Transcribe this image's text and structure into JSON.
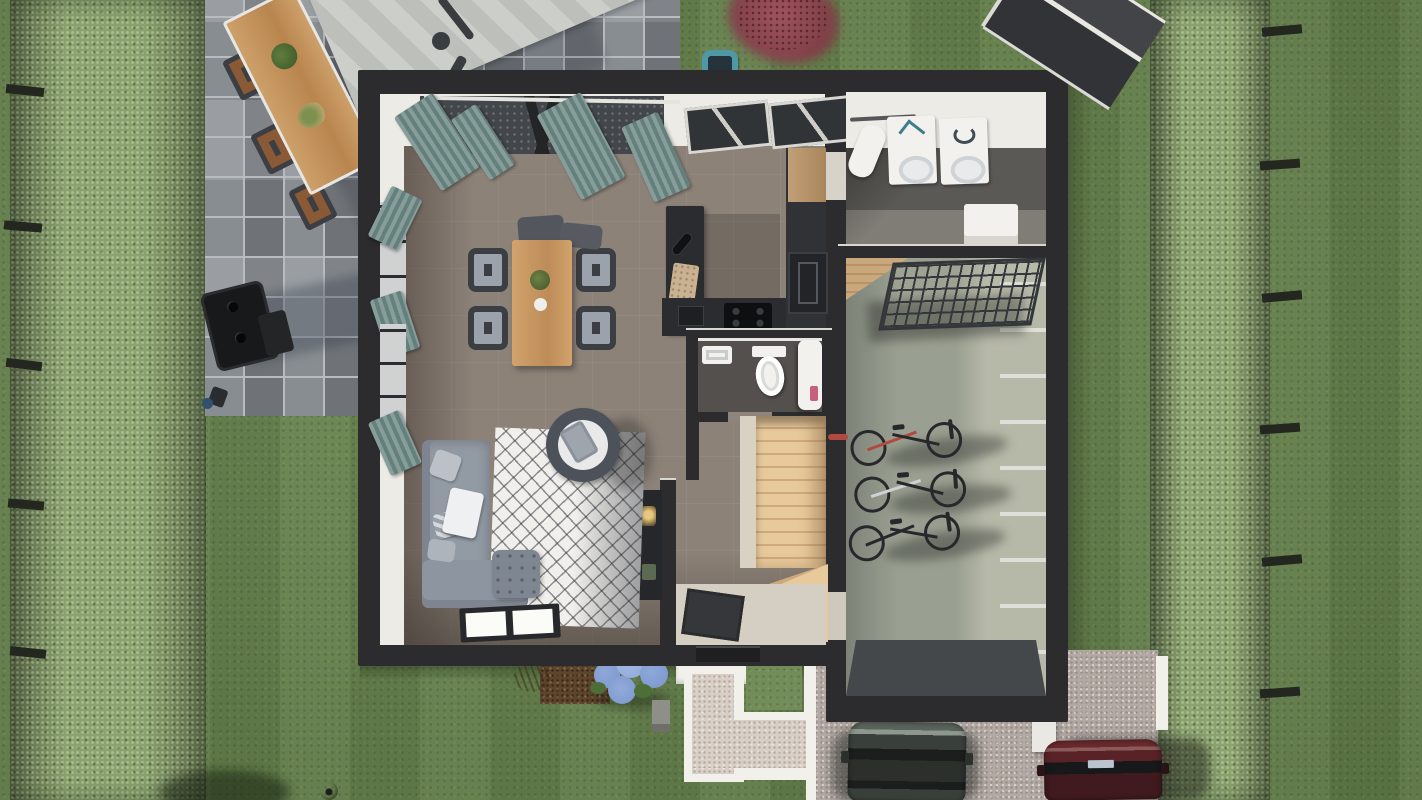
{
  "meta": {
    "view": "top-down 3D architectural floor-plan render",
    "rooms": [
      "living-dining-room",
      "kitchen",
      "wc",
      "entry-hall",
      "staircase",
      "laundry-room",
      "garage"
    ],
    "garden_objects": [
      "lawn",
      "left-hedge",
      "right-hedge",
      "fence-posts",
      "patio",
      "outdoor-dining-table",
      "outdoor-chairs",
      "cantilever-parasol",
      "bbq-grill",
      "garden-tap",
      "robot-mower-dock",
      "red-bush",
      "garden-shed",
      "hydrangea",
      "mulch-bed",
      "stoop",
      "l-shaped-path",
      "driveway",
      "car-gray",
      "car-red",
      "gate-post",
      "soccer-ball"
    ],
    "interior_objects": [
      "dining-table",
      "dining-chairs",
      "kitchen-island",
      "kitchen-counter",
      "hob",
      "tall-cabinet",
      "oven",
      "toilet",
      "wc-sink",
      "shower-column",
      "stairs",
      "winder-steps",
      "door-mat",
      "front-door",
      "shelf-unit",
      "corner-sofa",
      "ottoman",
      "rug",
      "tub-chair",
      "floor-window",
      "washing-machine",
      "dryer",
      "ironing-board",
      "water-heater",
      "wire-rack",
      "bicycles"
    ]
  },
  "colors": {
    "lawn": "#66834b",
    "hedge": "#8ba36c",
    "post": "#23271f",
    "paver": "#868b90",
    "paverJoint": "#b8bcc1",
    "parasol": "#c8cbc6",
    "parasolArm": "#3a3d3f",
    "woodOutdoor": "#c59a62",
    "chairBrown": "#8a5a36",
    "chairDarkFrame": "#3b3e42",
    "bbq": "#17191b",
    "wall": "#2c2b2e",
    "innerWall": "#edebe6",
    "floorTaupe": "#8c8278",
    "curtain": "#879d9a",
    "curtainDark": "#64807d",
    "woodTable": "#d2a36c",
    "kitchenDark": "#2b2c2f",
    "hob": "#0e0f10",
    "wcFloor": "#53504d",
    "white": "#f2f1ee",
    "stairWood": "#e8c99c",
    "stairWoodDark": "#cfa97c",
    "hallFloor": "#d5cfc3",
    "mat": "#36373a",
    "shelf": "#26272a",
    "sofa": "#929aa4",
    "sofaLight": "#bcc1c8",
    "pouf": "#7e8692",
    "rug": "#f0efeb",
    "tubChair": "#4d525a",
    "garageFloor": "#9aa091",
    "garageWall": "#d6d0c0",
    "apron": "#45484b",
    "laundryFloorDark": "#5b5955",
    "laundryFloorLight": "#807d77",
    "appliance": "#f3f2ef",
    "rack": "#34373a",
    "bike": "#26282b",
    "bikeRed": "#b0493f",
    "gravelPath": "#d8cfc6",
    "pathWhite": "#f2f0ea",
    "driveway": "#b2a9a3",
    "car1": "#39403b",
    "car1Hood": "#5a635c",
    "glass": "#1b1e1c",
    "car2": "#582226",
    "car2Hood": "#6a2a2e",
    "hydrangea": "#8ea8d9",
    "hydrangeaDark": "#7b96cc",
    "leaf": "#4e6e38",
    "mulch": "#5d452c",
    "redBush": "#a0545c",
    "redBushDark": "#7e3e47",
    "shed": "#3f4043",
    "shedTrim": "#e9e7e2",
    "dock": "#4f98a8",
    "ball": "#e8e8e6"
  }
}
